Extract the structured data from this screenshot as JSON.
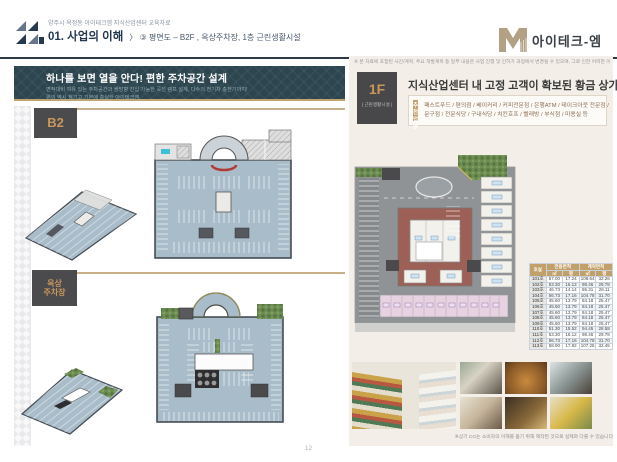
{
  "header": {
    "eyebrow": "양주시 옥정동 아이테크엠 지식산업센터 교육자료",
    "section_no": "01. 사업의 이해",
    "breadcrumb": "〉 ③ 평면도 – B2F , 옥상주차장, 1층 근린생활시설",
    "brand": "아이테크-엠"
  },
  "left_panel": {
    "headline": "하나를 보면 열을 안다! 편한 주차공간 설계",
    "sublines": [
      "면적대비 여유 있는 주차공간과 쌍방향 진입 가능한 곡선 램프 설계, 다수의 전기차 충전기까지!",
      "편의 역시 챙기고 기본에 충실한 아이테크엠"
    ],
    "b2_label": "B2",
    "roof_label": [
      "옥상",
      "주차장"
    ]
  },
  "right_panel": {
    "disclaimer": "※ 본 자료에 포함된 사진/계획, 주요 개발계획 등 일부 내용은 사업 진행 및 인허가 과정에서 변경될 수 있으며, 그로 인한 어떠한 이의 제기도 할 수 없습니다.",
    "floor_badge": "1F",
    "floor_badge_sub": "| 근린생활시설 |",
    "headline": "지식산업센터 내 고정 고객이 확보된 황금 상가",
    "shops_tag": [
      "추천",
      "업종"
    ],
    "shops_lines": [
      "패스트푸드 / 편의점 / 베이커리 / 커피전문점 / 은행ATM / 테이크아웃 전문점 /",
      "문구점 / 전문식당 / 구내식당 / 치킨호프 / 빨래방 / 부식점 / 미용실 등"
    ],
    "area_table": {
      "headers": {
        "unit": "호실",
        "exclusive": "전용면적",
        "contract": "계약면적",
        "sqm": "㎡",
        "pyeong": "평"
      },
      "rows": [
        [
          "101호",
          "57.00",
          "17.24",
          "106.64",
          "32.26"
        ],
        [
          "102호",
          "53.30",
          "16.12",
          "98.46",
          "29.78"
        ],
        [
          "103호",
          "46.73",
          "14.14",
          "86.31",
          "26.11"
        ],
        [
          "104호",
          "56.73",
          "17.16",
          "104.78",
          "31.70"
        ],
        [
          "105호",
          "45.60",
          "13.79",
          "84.18",
          "25.47"
        ],
        [
          "106호",
          "45.60",
          "13.79",
          "84.18",
          "25.47"
        ],
        [
          "107호",
          "45.60",
          "13.79",
          "84.18",
          "25.47"
        ],
        [
          "108호",
          "45.60",
          "13.79",
          "84.18",
          "25.47"
        ],
        [
          "109호",
          "45.60",
          "13.79",
          "84.18",
          "25.47"
        ],
        [
          "110호",
          "51.30",
          "15.52",
          "94.45",
          "28.58"
        ],
        [
          "111호",
          "53.30",
          "16.12",
          "98.46",
          "29.78"
        ],
        [
          "112호",
          "56.73",
          "17.16",
          "104.78",
          "31.70"
        ],
        [
          "113호",
          "58.90",
          "17.82",
          "107.25",
          "32.45"
        ]
      ]
    },
    "photo_caption": "※상기 CG는 소비자의 이해를 돕기 위해 제작된 것으로 실제와 다를 수 있습니다"
  },
  "footer": {
    "page_number": "12"
  },
  "colors": {
    "accent_gold": "#c2a06a",
    "dark_teal": "#2c454e",
    "dark_box": "#4a4a4c",
    "parking_deck": "#a9bcc9"
  }
}
